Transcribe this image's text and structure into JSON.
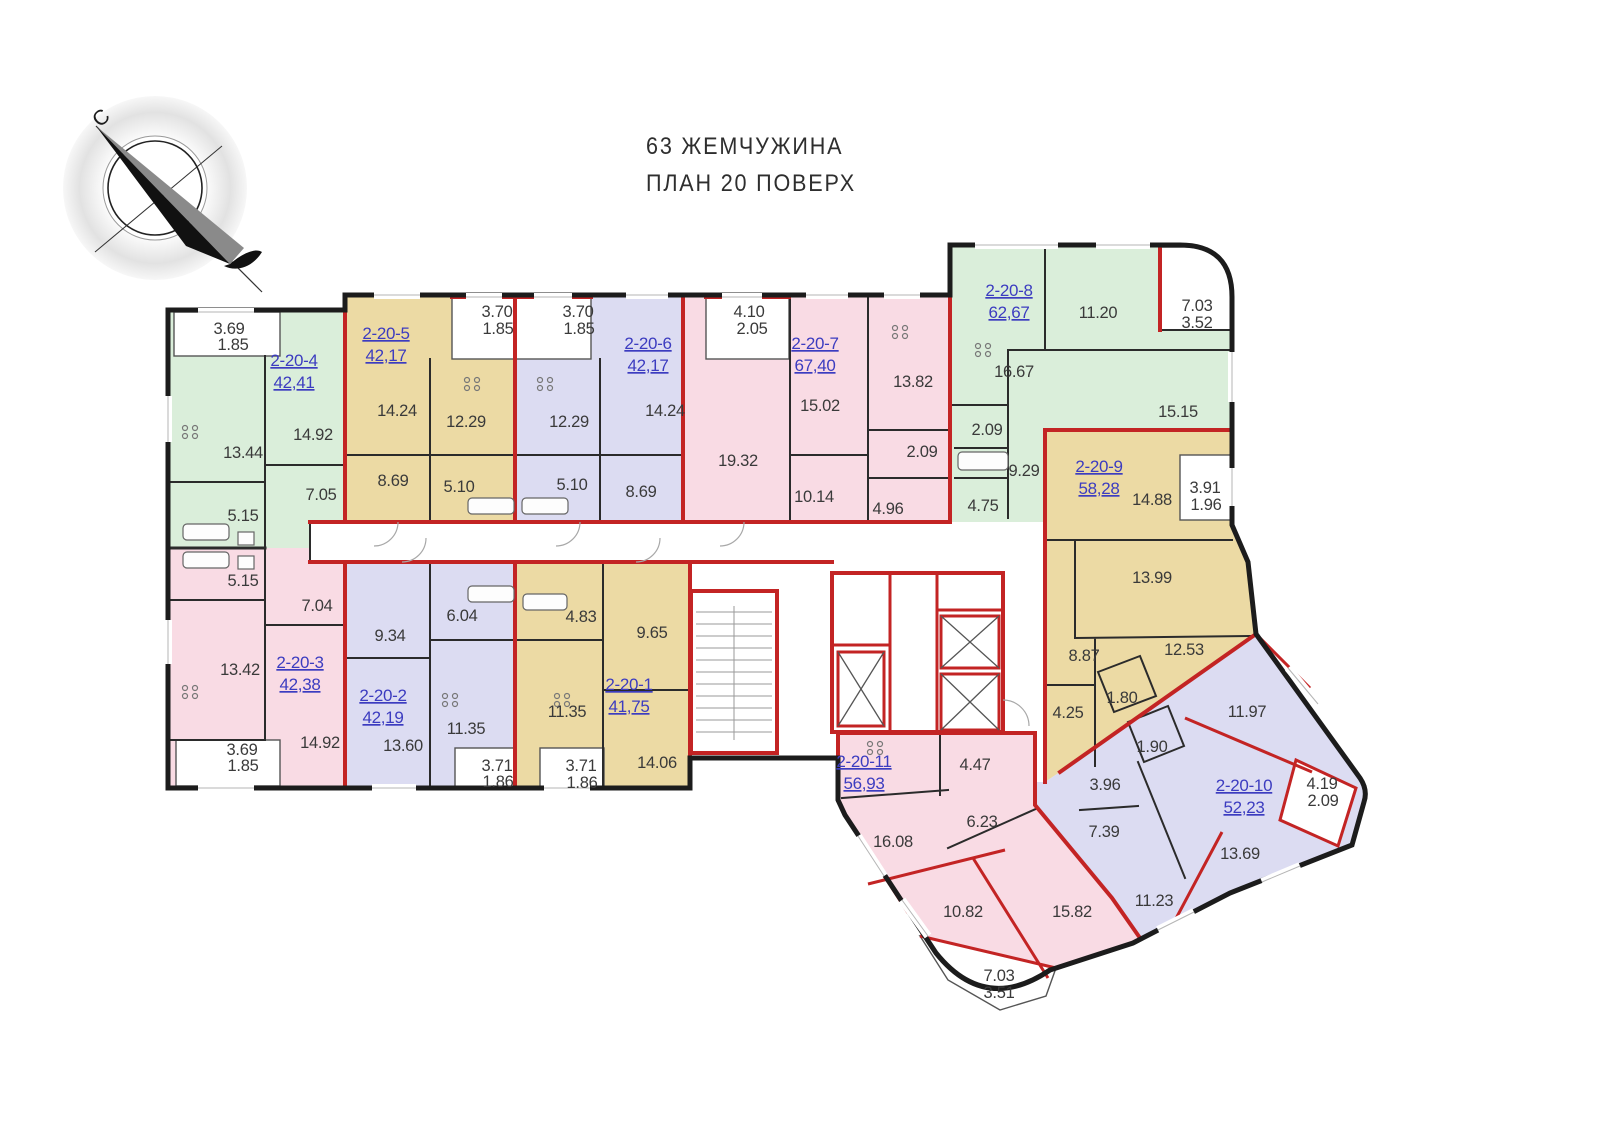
{
  "title": {
    "line1": "63 ЖЕМЧУЖИНА",
    "line2": "ПЛАН 20 ПОВЕРХ"
  },
  "compass": {
    "north_label": "С"
  },
  "colors": {
    "green": "#daeeda",
    "tan": "#ecdaa4",
    "lavender": "#dcdcf2",
    "pink": "#f9dbe4",
    "red_wall": "#c32424",
    "dark_wall": "#1c1c1c",
    "label_blue": "#3c3cc0",
    "room_text": "#3a3a3a"
  },
  "apartments": [
    {
      "id": "2-20-1",
      "area": "41,75",
      "color": "tan",
      "label": {
        "x": 629,
        "y": 690
      },
      "rooms": [
        {
          "v": "4.83",
          "x": 581,
          "y": 622
        },
        {
          "v": "9.65",
          "x": 652,
          "y": 638
        },
        {
          "v": "11.35",
          "x": 567,
          "y": 717
        },
        {
          "v": "14.06",
          "x": 657,
          "y": 768
        },
        {
          "v": "3.71",
          "x": 581,
          "y": 771
        },
        {
          "v": "1.86",
          "x": 582,
          "y": 788
        }
      ]
    },
    {
      "id": "2-20-2",
      "area": "42,19",
      "color": "lavender",
      "label": {
        "x": 383,
        "y": 701
      },
      "rooms": [
        {
          "v": "9.34",
          "x": 390,
          "y": 641
        },
        {
          "v": "6.04",
          "x": 462,
          "y": 621
        },
        {
          "v": "13.60",
          "x": 403,
          "y": 751
        },
        {
          "v": "11.35",
          "x": 466,
          "y": 734
        },
        {
          "v": "3.71",
          "x": 497,
          "y": 771
        },
        {
          "v": "1.86",
          "x": 498,
          "y": 787
        }
      ]
    },
    {
      "id": "2-20-3",
      "area": "42,38",
      "color": "pink",
      "label": {
        "x": 300,
        "y": 668
      },
      "rooms": [
        {
          "v": "5.15",
          "x": 243,
          "y": 586
        },
        {
          "v": "7.04",
          "x": 317,
          "y": 611
        },
        {
          "v": "13.42",
          "x": 240,
          "y": 675
        },
        {
          "v": "14.92",
          "x": 320,
          "y": 748
        },
        {
          "v": "3.69",
          "x": 242,
          "y": 755
        },
        {
          "v": "1.85",
          "x": 243,
          "y": 771
        }
      ]
    },
    {
      "id": "2-20-4",
      "area": "42,41",
      "color": "green",
      "label": {
        "x": 294,
        "y": 366
      },
      "rooms": [
        {
          "v": "3.69",
          "x": 229,
          "y": 334
        },
        {
          "v": "1.85",
          "x": 233,
          "y": 350
        },
        {
          "v": "13.44",
          "x": 243,
          "y": 458
        },
        {
          "v": "14.92",
          "x": 313,
          "y": 440
        },
        {
          "v": "7.05",
          "x": 321,
          "y": 500
        },
        {
          "v": "5.15",
          "x": 243,
          "y": 521
        }
      ]
    },
    {
      "id": "2-20-5",
      "area": "42,17",
      "color": "tan",
      "label": {
        "x": 386,
        "y": 339
      },
      "rooms": [
        {
          "v": "3.70",
          "x": 497,
          "y": 317
        },
        {
          "v": "1.85",
          "x": 498,
          "y": 334
        },
        {
          "v": "14.24",
          "x": 397,
          "y": 416
        },
        {
          "v": "12.29",
          "x": 466,
          "y": 427
        },
        {
          "v": "8.69",
          "x": 393,
          "y": 486
        },
        {
          "v": "5.10",
          "x": 459,
          "y": 492
        }
      ]
    },
    {
      "id": "2-20-6",
      "area": "42,17",
      "color": "lavender",
      "label": {
        "x": 648,
        "y": 349
      },
      "rooms": [
        {
          "v": "3.70",
          "x": 578,
          "y": 317
        },
        {
          "v": "1.85",
          "x": 579,
          "y": 334
        },
        {
          "v": "12.29",
          "x": 569,
          "y": 427
        },
        {
          "v": "14.24",
          "x": 665,
          "y": 416
        },
        {
          "v": "5.10",
          "x": 572,
          "y": 490
        },
        {
          "v": "8.69",
          "x": 641,
          "y": 497
        }
      ]
    },
    {
      "id": "2-20-7",
      "area": "67,40",
      "color": "pink",
      "label": {
        "x": 815,
        "y": 349
      },
      "rooms": [
        {
          "v": "4.10",
          "x": 749,
          "y": 317
        },
        {
          "v": "2.05",
          "x": 752,
          "y": 334
        },
        {
          "v": "15.02",
          "x": 820,
          "y": 411
        },
        {
          "v": "13.82",
          "x": 913,
          "y": 387
        },
        {
          "v": "19.32",
          "x": 738,
          "y": 466
        },
        {
          "v": "10.14",
          "x": 814,
          "y": 502
        },
        {
          "v": "2.09",
          "x": 922,
          "y": 457
        },
        {
          "v": "4.96",
          "x": 888,
          "y": 514
        }
      ]
    },
    {
      "id": "2-20-8",
      "area": "62,67",
      "color": "green",
      "label": {
        "x": 1009,
        "y": 296
      },
      "rooms": [
        {
          "v": "11.20",
          "x": 1098,
          "y": 318
        },
        {
          "v": "7.03",
          "x": 1197,
          "y": 311
        },
        {
          "v": "3.52",
          "x": 1197,
          "y": 328
        },
        {
          "v": "16.67",
          "x": 1014,
          "y": 377
        },
        {
          "v": "15.15",
          "x": 1178,
          "y": 417
        },
        {
          "v": "2.09",
          "x": 987,
          "y": 435
        },
        {
          "v": "9.29",
          "x": 1024,
          "y": 476
        },
        {
          "v": "4.75",
          "x": 983,
          "y": 511
        }
      ]
    },
    {
      "id": "2-20-9",
      "area": "58,28",
      "color": "tan",
      "label": {
        "x": 1099,
        "y": 472
      },
      "rooms": [
        {
          "v": "14.88",
          "x": 1152,
          "y": 505
        },
        {
          "v": "3.91",
          "x": 1205,
          "y": 493
        },
        {
          "v": "1.96",
          "x": 1206,
          "y": 510
        },
        {
          "v": "13.99",
          "x": 1152,
          "y": 583
        },
        {
          "v": "12.53",
          "x": 1184,
          "y": 655
        },
        {
          "v": "8.87",
          "x": 1084,
          "y": 661
        },
        {
          "v": "4.25",
          "x": 1068,
          "y": 718
        },
        {
          "v": "1.80",
          "x": 1122,
          "y": 703
        }
      ]
    },
    {
      "id": "2-20-10",
      "area": "52,23",
      "color": "lavender",
      "label": {
        "x": 1244,
        "y": 791
      },
      "rooms": [
        {
          "v": "11.97",
          "x": 1247,
          "y": 717
        },
        {
          "v": "1.90",
          "x": 1152,
          "y": 752
        },
        {
          "v": "3.96",
          "x": 1105,
          "y": 790
        },
        {
          "v": "7.39",
          "x": 1104,
          "y": 837
        },
        {
          "v": "11.23",
          "x": 1154,
          "y": 906
        },
        {
          "v": "13.69",
          "x": 1240,
          "y": 859
        },
        {
          "v": "4.19",
          "x": 1322,
          "y": 789
        },
        {
          "v": "2.09",
          "x": 1323,
          "y": 806
        }
      ]
    },
    {
      "id": "2-20-11",
      "area": "56,93",
      "color": "pink",
      "label": {
        "x": 864,
        "y": 767
      },
      "rooms": [
        {
          "v": "4.47",
          "x": 975,
          "y": 770
        },
        {
          "v": "6.23",
          "x": 982,
          "y": 827
        },
        {
          "v": "16.08",
          "x": 893,
          "y": 847
        },
        {
          "v": "10.82",
          "x": 963,
          "y": 917
        },
        {
          "v": "15.82",
          "x": 1072,
          "y": 917
        },
        {
          "v": "7.03",
          "x": 999,
          "y": 981
        },
        {
          "v": "3.51",
          "x": 999,
          "y": 998
        }
      ]
    }
  ]
}
